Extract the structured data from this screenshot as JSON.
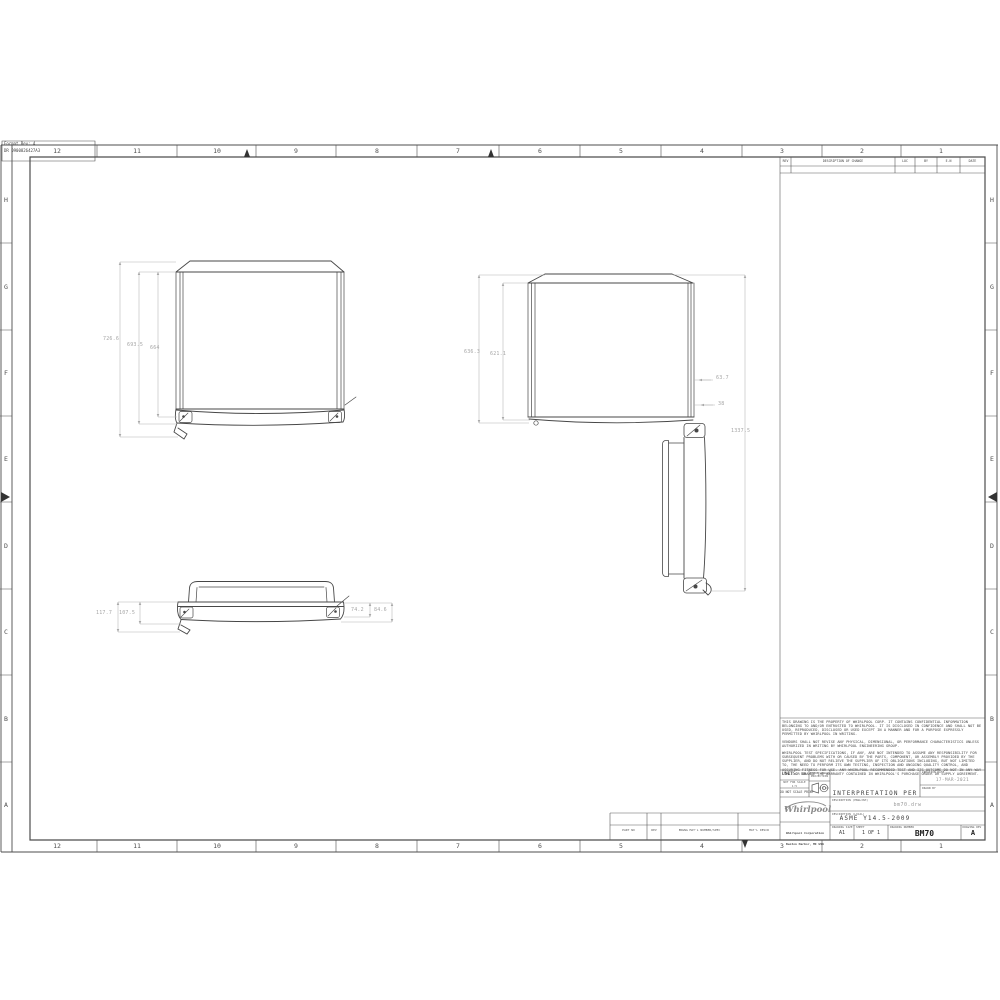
{
  "sheet": {
    "format_box": {
      "line1": "Format Rev: 4",
      "line2": "DR 0900826427A3"
    },
    "zones": {
      "columns": [
        "12",
        "11",
        "10",
        "9",
        "8",
        "7",
        "6",
        "5",
        "4",
        "3",
        "2",
        "1"
      ],
      "rows": [
        "H",
        "G",
        "F",
        "E",
        "D",
        "C",
        "B",
        "A"
      ]
    }
  },
  "revision_table": {
    "col_rev": "REV",
    "col_desc": "DESCRIPTION OF CHANGE",
    "col_loc": "LOC",
    "col_by": "BY",
    "col_en": "E.N",
    "col_date": "DATE"
  },
  "notes": {
    "p1": "THIS DRAWING IS THE PROPERTY OF WHIRLPOOL CORP. IT CONTAINS CONFIDENTIAL INFORMATION BELONGING TO AND/OR ENTRUSTED TO WHIRLPOOL. IT IS DISCLOSED IN CONFIDENCE AND SHALL NOT BE USED, REPRODUCED, DISCLOSED OR USED EXCEPT IN A MANNER AND FOR A PURPOSE EXPRESSLY PERMITTED BY WHIRLPOOL IN WRITING.",
    "p2": "VENDORS SHALL NOT REVISE ANY PHYSICAL, DIMENSIONAL, OR PERFORMANCE CHARACTERISTICS UNLESS AUTHORIZED IN WRITING BY WHIRLPOOL ENGINEERING GROUP.",
    "p3": "WHIRLPOOL TEST SPECIFICATIONS, IF ANY, ARE NOT INTENDED TO ASSUME ANY RESPONSIBILITY FOR SUBSEQUENT PROBLEMS WITH OR CAUSED BY THE PARTS, COMPONENT, OR ASSEMBLY PROVIDED BY THE SUPPLIER, AND DO NOT RELIEVE THE SUPPLIER OF ITS OBLIGATIONS INCLUDING, BUT NOT LIMITED TO, THE NEED TO PERFORM ITS OWN TESTING, INSPECTION AND ONGOING QUALITY CONTROL, AND ASSURING FITNESS FOR USE. ANY WHIRLPOOL RECOMMENDED TEST AND ITS OUTCOME DO NOT IN ANY WAY LIMIT OR CHANGE THE WARRANTY CONTAINED IN WHIRLPOOL'S PURCHASE ORDER OR SUPPLY AGREEMENT."
  },
  "title_block": {
    "units": "UNITS: mm",
    "scale_line1": "NOT FOR SCALE",
    "scale_line2": "1:5",
    "do_not_scale": "DO NOT SCALE PRINT",
    "third_angle": "THIRD ANGLE PROJECTION",
    "interpretation_line1": "INTERPRETATION PER",
    "interpretation_line2": "ASME Y14.5-2009",
    "creation_date_label": "CREATION DATE",
    "creation_date": "17-MAR-2021",
    "drawn_by_label": "DRAWN BY",
    "description_english_label": "DESCRIPTION (ENGLISH)",
    "description_english": "bm70.drw",
    "description_local_label": "DESCRIPTION (LOCAL)",
    "logo_text": "Whirlpool",
    "company_line1": "Whirlpool Corporation",
    "company_line2": "Benton Harbor, MI USA",
    "drawing_size_label": "DRAWING SIZE",
    "drawing_size": "A1",
    "sheet_label": "SHEET",
    "sheet_value": "1 OF 1",
    "drawing_number_label": "DRAWING NUMBER",
    "drawing_number": "BM70",
    "drawing_rev_label": "DRAWING REV",
    "drawing_rev": "A"
  },
  "parts_strip": {
    "col1": "PART NO",
    "col2": "REV",
    "col3": "ENGNG MAT'L NUMBER/SPEC",
    "col4": "MAT'L DESCR"
  },
  "views": {
    "front": {
      "dims": {
        "overall_height": "726.6",
        "mid_height": "693.5",
        "inner_height": "664"
      }
    },
    "side": {
      "dims": {
        "overall_height": "636.3",
        "inner_height": "621.1",
        "door_offset": "63.7",
        "door_gap": "38",
        "open_height": "1337.5"
      }
    },
    "bottom": {
      "dims": {
        "left_outer": "117.7",
        "left_inner": "107.5",
        "right_inner": "74.2",
        "right_outer": "84.6"
      }
    }
  }
}
